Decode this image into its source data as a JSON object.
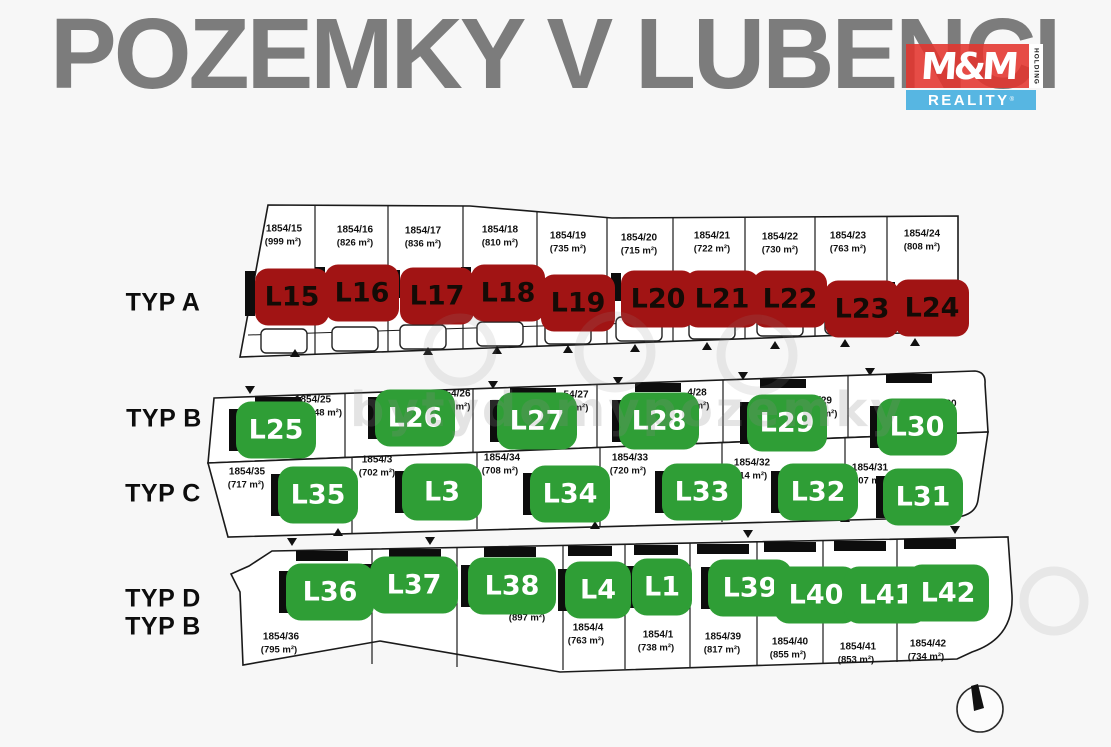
{
  "header": {
    "title": "POZEMKY V LUBENCI",
    "title_color": "#7c7c7c"
  },
  "logo": {
    "mm": "M&M",
    "holding": "HOLDING",
    "reality": "REALITY",
    "registered": "®",
    "red": "#e4342e",
    "blue": "#57b6e2"
  },
  "colors": {
    "sold_label": "#a11414",
    "available_label": "#2f9e36",
    "map_line": "#1a1a1a",
    "background": "#f7f7f7"
  },
  "watermark": {
    "text": "bytydomypozemky"
  },
  "icons": {
    "compass": "north-compass-icon"
  },
  "map": {
    "rows": [
      {
        "id": "typ-a",
        "type_labels": [
          "TYP A"
        ],
        "tl_x": 163,
        "tl_y": 303,
        "plots": [
          {
            "label": "L15",
            "status": "sold",
            "parcel": "1854/15",
            "area": "(999 m²)",
            "px": 284,
            "py": 229,
            "ax": 283,
            "ay": 242,
            "lx": 292,
            "ly": 297
          },
          {
            "label": "L16",
            "status": "sold",
            "parcel": "1854/16",
            "area": "(826 m²)",
            "px": 355,
            "py": 230,
            "ax": 355,
            "ay": 243,
            "lx": 362,
            "ly": 293
          },
          {
            "label": "L17",
            "status": "sold",
            "parcel": "1854/17",
            "area": "(836 m²)",
            "px": 423,
            "py": 231,
            "ax": 423,
            "ay": 244,
            "lx": 437,
            "ly": 296
          },
          {
            "label": "L18",
            "status": "sold",
            "parcel": "1854/18",
            "area": "(810 m²)",
            "px": 500,
            "py": 230,
            "ax": 500,
            "ay": 243,
            "lx": 508,
            "ly": 293
          },
          {
            "label": "L19",
            "status": "sold",
            "parcel": "1854/19",
            "area": "(735 m²)",
            "px": 568,
            "py": 236,
            "ax": 568,
            "ay": 249,
            "lx": 578,
            "ly": 303
          },
          {
            "label": "L20",
            "status": "sold",
            "parcel": "1854/20",
            "area": "(715 m²)",
            "px": 639,
            "py": 238,
            "ax": 639,
            "ay": 251,
            "lx": 658,
            "ly": 299
          },
          {
            "label": "L21",
            "status": "sold",
            "parcel": "1854/21",
            "area": "(722 m²)",
            "px": 712,
            "py": 236,
            "ax": 712,
            "ay": 249,
            "lx": 722,
            "ly": 299
          },
          {
            "label": "L22",
            "status": "sold",
            "parcel": "1854/22",
            "area": "(730 m²)",
            "px": 780,
            "py": 237,
            "ax": 780,
            "ay": 250,
            "lx": 790,
            "ly": 299
          },
          {
            "label": "L23",
            "status": "sold",
            "parcel": "1854/23",
            "area": "(763 m²)",
            "px": 848,
            "py": 236,
            "ax": 848,
            "ay": 249,
            "lx": 862,
            "ly": 309
          },
          {
            "label": "L24",
            "status": "sold",
            "parcel": "1854/24",
            "area": "(808 m²)",
            "px": 922,
            "py": 234,
            "ax": 922,
            "ay": 247,
            "lx": 932,
            "ly": 308
          }
        ]
      },
      {
        "id": "typ-b",
        "type_labels": [
          "TYP B"
        ],
        "tl_x": 164,
        "tl_y": 419,
        "plots": [
          {
            "label": "L25",
            "status": "available",
            "parcel": "1854/25",
            "area": "48 m²)",
            "px": 313,
            "py": 400,
            "ax": 328,
            "ay": 413,
            "lx": 276,
            "ly": 430
          },
          {
            "label": "L26",
            "status": "available",
            "parcel": "54/26",
            "area": "m²)",
            "px": 458,
            "py": 394,
            "ax": 463,
            "ay": 407,
            "lx": 415,
            "ly": 418
          },
          {
            "label": "L27",
            "status": "available",
            "parcel": "54/27",
            "area": "m²)",
            "px": 576,
            "py": 395,
            "ax": 581,
            "ay": 408,
            "lx": 537,
            "ly": 421
          },
          {
            "label": "L28",
            "status": "available",
            "parcel": "4/28",
            "area": "m²)",
            "px": 697,
            "py": 393,
            "ax": 702,
            "ay": 406,
            "lx": 659,
            "ly": 421
          },
          {
            "label": "L29",
            "status": "available",
            "parcel": "/29",
            "area": "m²)",
            "px": 825,
            "py": 401,
            "ax": 830,
            "ay": 414,
            "lx": 787,
            "ly": 423
          },
          {
            "label": "L30",
            "status": "available",
            "parcel": "30",
            "area": ")",
            "px": 951,
            "py": 404,
            "ax": 955,
            "ay": 417,
            "lx": 917,
            "ly": 427
          }
        ]
      },
      {
        "id": "typ-c",
        "type_labels": [
          "TYP C"
        ],
        "tl_x": 163,
        "tl_y": 494,
        "plots": [
          {
            "label": "L35",
            "status": "available",
            "parcel": "1854/35",
            "area": "(717 m²)",
            "px": 247,
            "py": 472,
            "ax": 246,
            "ay": 485,
            "lx": 318,
            "ly": 495
          },
          {
            "label": "L3",
            "status": "available",
            "parcel": "1854/3",
            "area": "(702 m²)",
            "px": 377,
            "py": 460,
            "ax": 377,
            "ay": 473,
            "lx": 442,
            "ly": 492
          },
          {
            "label": "L34",
            "status": "available",
            "parcel": "1854/34",
            "area": "(708 m²)",
            "px": 502,
            "py": 458,
            "ax": 500,
            "ay": 471,
            "lx": 570,
            "ly": 494
          },
          {
            "label": "L33",
            "status": "available",
            "parcel": "1854/33",
            "area": "(720 m²)",
            "px": 630,
            "py": 458,
            "ax": 628,
            "ay": 471,
            "lx": 702,
            "ly": 492
          },
          {
            "label": "L32",
            "status": "available",
            "parcel": "1854/32",
            "area": "(714 m²)",
            "px": 752,
            "py": 463,
            "ax": 749,
            "ay": 476,
            "lx": 818,
            "ly": 492
          },
          {
            "label": "L31",
            "status": "available",
            "parcel": "1854/31",
            "area": "(707 m²)",
            "px": 870,
            "py": 468,
            "ax": 868,
            "ay": 481,
            "lx": 923,
            "ly": 497
          }
        ]
      },
      {
        "id": "typ-d",
        "type_labels": [
          "TYP D",
          "TYP B"
        ],
        "tl_x": 163,
        "tl_y": 599,
        "plots": [
          {
            "label": "L36",
            "status": "available",
            "parcel": "1854/36",
            "area": "(795 m²)",
            "px": 281,
            "py": 637,
            "ax": 279,
            "ay": 650,
            "lx": 330,
            "ly": 592,
            "w": 88
          },
          {
            "label": "L37",
            "status": "available",
            "parcel": "",
            "area": "",
            "px": 0,
            "py": 0,
            "ax": 0,
            "ay": 0,
            "lx": 414,
            "ly": 585,
            "w": 88
          },
          {
            "label": "L38",
            "status": "available",
            "parcel": "",
            "area": "(897 m²)",
            "px": 0,
            "py": 0,
            "ax": 527,
            "ay": 618,
            "lx": 512,
            "ly": 586,
            "w": 88
          },
          {
            "label": "L4",
            "status": "available",
            "parcel": "1854/4",
            "area": "(763 m²)",
            "px": 588,
            "py": 628,
            "ax": 586,
            "ay": 641,
            "lx": 598,
            "ly": 590,
            "w": 66
          },
          {
            "label": "L1",
            "status": "available",
            "parcel": "1854/1",
            "area": "(738 m²)",
            "px": 658,
            "py": 635,
            "ax": 656,
            "ay": 648,
            "lx": 662,
            "ly": 587,
            "w": 60
          },
          {
            "label": "L39",
            "status": "available",
            "parcel": "1854/39",
            "area": "(817 m²)",
            "px": 723,
            "py": 637,
            "ax": 722,
            "ay": 650,
            "lx": 750,
            "ly": 588,
            "w": 84
          },
          {
            "label": "L40",
            "status": "available",
            "parcel": "1854/40",
            "area": "(855 m²)",
            "px": 790,
            "py": 642,
            "ax": 788,
            "ay": 655,
            "lx": 816,
            "ly": 595,
            "w": 84
          },
          {
            "label": "L41",
            "status": "available",
            "parcel": "1854/41",
            "area": "(853 m²)",
            "px": 858,
            "py": 647,
            "ax": 856,
            "ay": 660,
            "lx": 886,
            "ly": 595,
            "w": 84
          },
          {
            "label": "L42",
            "status": "available",
            "parcel": "1854/42",
            "area": "(734 m²)",
            "px": 928,
            "py": 644,
            "ax": 926,
            "ay": 657,
            "lx": 948,
            "ly": 593,
            "w": 82
          }
        ]
      }
    ]
  }
}
